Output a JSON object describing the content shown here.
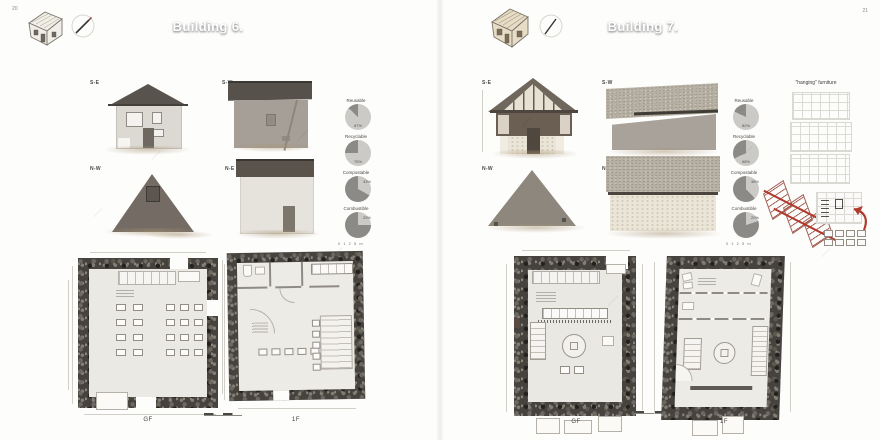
{
  "colors": {
    "pie_dark": "#8b8a87",
    "pie_light": "#cbcac7",
    "accent_red": "#b03a2e"
  },
  "pages": [
    {
      "page_number": "20",
      "header_title": "Building 6.",
      "elevation_labels": {
        "se": "S-E",
        "sw": "S-W",
        "nw": "N-W",
        "ne": "N-E"
      },
      "pies": [
        {
          "label": "Reusable",
          "dark_pct": 13,
          "value_label": "87%"
        },
        {
          "label": "Recyclable",
          "dark_pct": 25,
          "value_label": "75%"
        },
        {
          "label": "Compostable",
          "dark_pct": 67,
          "value_label": "33%"
        },
        {
          "label": "Combustible",
          "dark_pct": 75,
          "value_label": "25%"
        }
      ],
      "pie_scale_text": "0 1 2 5 m",
      "plan_labels": {
        "gf": "GF",
        "f1": "1F"
      }
    },
    {
      "page_number": "21",
      "header_title": "Building 7.",
      "annotation_title": "\"hanging\" furniture",
      "elevation_labels": {
        "se": "S-E",
        "sw": "S-W",
        "nw": "N-W",
        "ne": "N-E"
      },
      "pies": [
        {
          "label": "Reusable",
          "dark_pct": 18,
          "value_label": "82%"
        },
        {
          "label": "Recyclable",
          "dark_pct": 32,
          "value_label": "68%"
        },
        {
          "label": "Compostable",
          "dark_pct": 62,
          "value_label": "38%"
        },
        {
          "label": "Combustible",
          "dark_pct": 80,
          "value_label": "20%"
        }
      ],
      "pie_scale_text": "0 1 2 5 m",
      "plan_labels": {
        "gf": "GF",
        "f1": "1F"
      }
    }
  ],
  "chart_data": [
    {
      "type": "pie",
      "title": "Building 6 — material fractions",
      "categories": [
        "Reusable",
        "Recyclable",
        "Compostable",
        "Combustible"
      ],
      "series": [
        {
          "name": "dark segment %",
          "values": [
            13,
            25,
            67,
            75
          ]
        },
        {
          "name": "light segment %",
          "values": [
            87,
            75,
            33,
            25
          ]
        }
      ],
      "labels_shown": [
        "87%",
        "75%",
        "33%",
        "25%"
      ],
      "legend_position": "above-each-pie"
    },
    {
      "type": "pie",
      "title": "Building 7 — material fractions",
      "categories": [
        "Reusable",
        "Recyclable",
        "Compostable",
        "Combustible"
      ],
      "series": [
        {
          "name": "dark segment %",
          "values": [
            18,
            32,
            62,
            80
          ]
        },
        {
          "name": "light segment %",
          "values": [
            82,
            68,
            38,
            20
          ]
        }
      ],
      "labels_shown": [
        "82%",
        "68%",
        "38%",
        "20%"
      ],
      "legend_position": "above-each-pie"
    }
  ]
}
